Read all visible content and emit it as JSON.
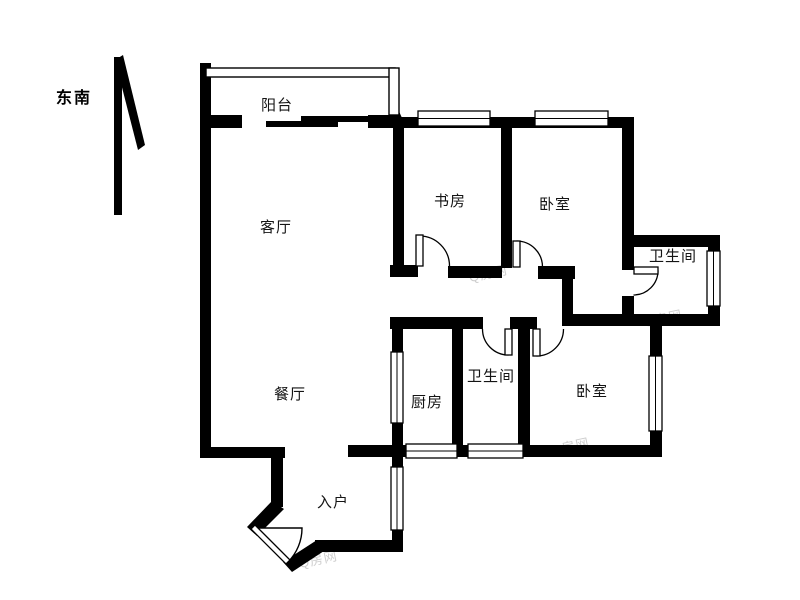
{
  "title": "apartment-floor-plan",
  "compass": {
    "label": "东南"
  },
  "rooms": [
    {
      "id": "balcony",
      "label": "阳台"
    },
    {
      "id": "living",
      "label": "客厅"
    },
    {
      "id": "study",
      "label": "书房"
    },
    {
      "id": "bedroom-1",
      "label": "卧室"
    },
    {
      "id": "bathroom-1",
      "label": "卫生间"
    },
    {
      "id": "dining",
      "label": "餐厅"
    },
    {
      "id": "kitchen",
      "label": "厨房"
    },
    {
      "id": "bathroom-2",
      "label": "卫生间"
    },
    {
      "id": "bedroom-2",
      "label": "卧室"
    },
    {
      "id": "entry",
      "label": "入户"
    }
  ],
  "watermark": {
    "text": "Q房网"
  },
  "colors": {
    "wall": "#000000",
    "background": "#ffffff",
    "label": "#141414",
    "watermark": "#bdbdbd"
  }
}
